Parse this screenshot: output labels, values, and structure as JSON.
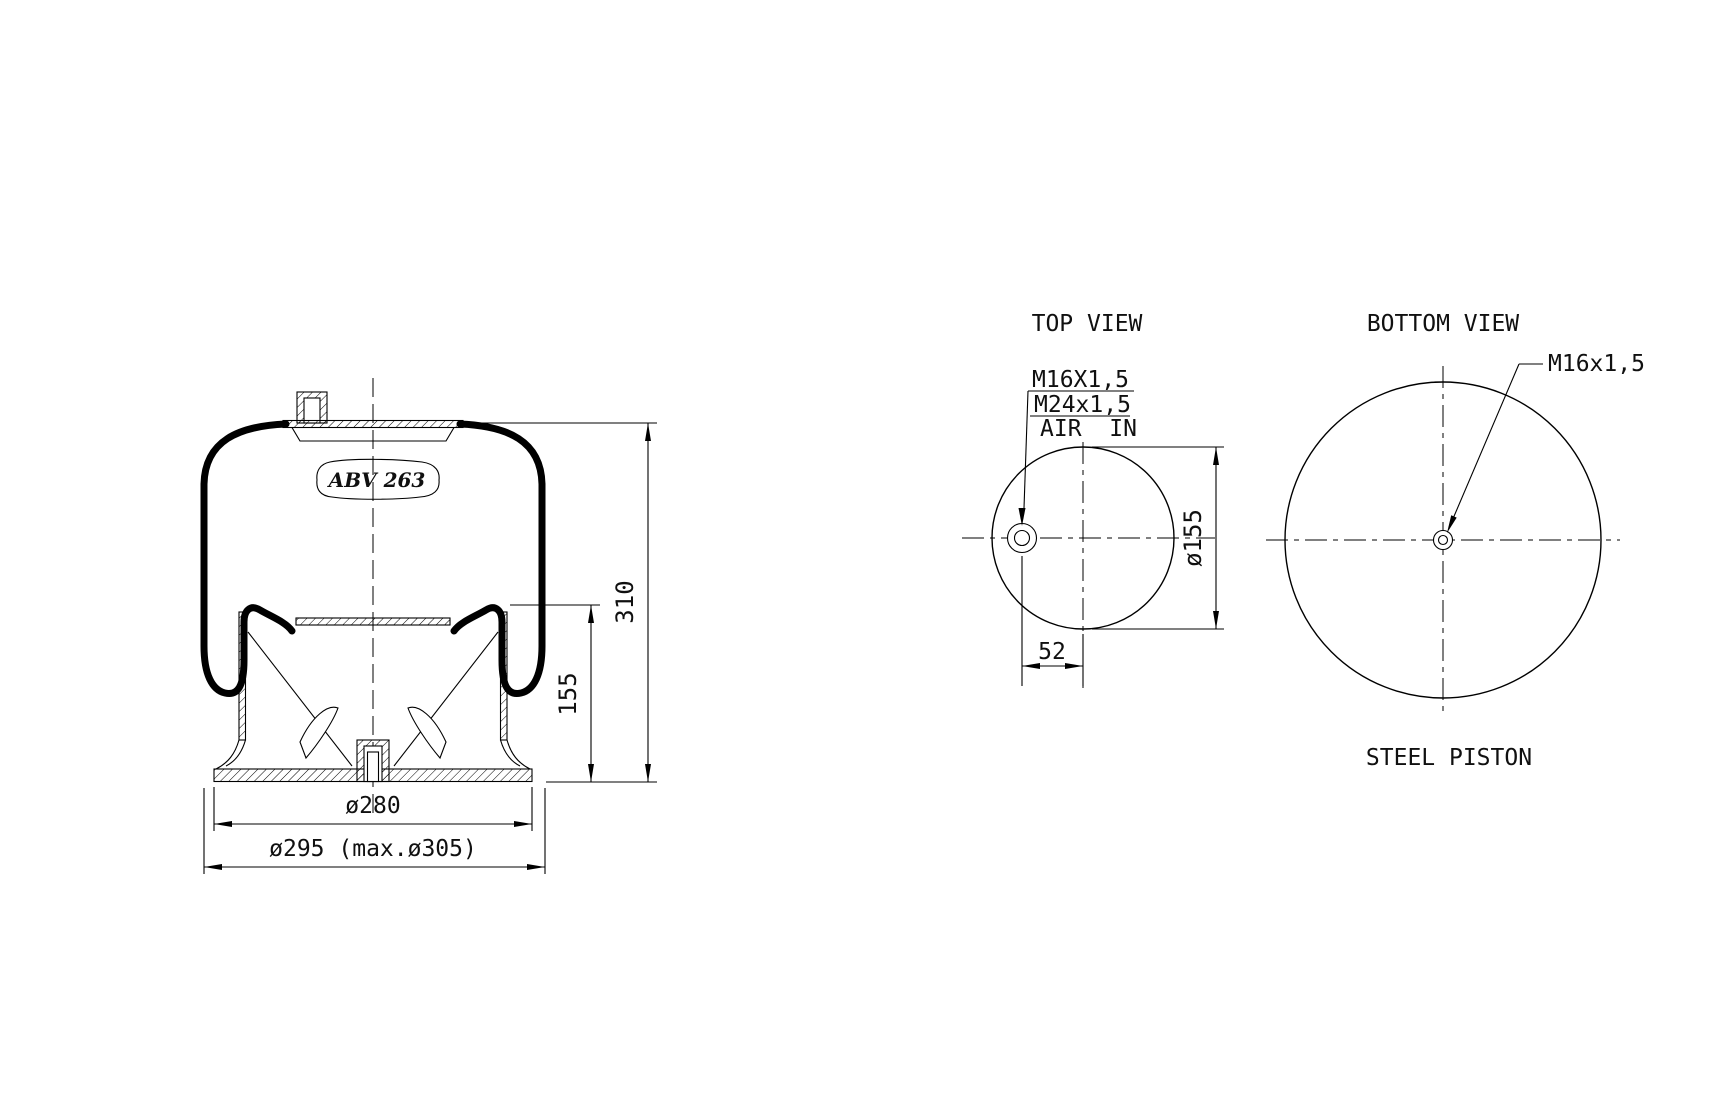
{
  "side_view": {
    "part_label": "ABV 263",
    "dims": {
      "total_height": "310",
      "piston_height": "155",
      "piston_diameter": "ø280",
      "max_diameter": "ø295 (max.ø305)"
    }
  },
  "top_view": {
    "title": "TOP VIEW",
    "thread_top": "M16X1,5",
    "thread_port": "M24x1,5",
    "air_in": "AIR  IN",
    "circle_diameter": "ø155",
    "port_offset": "52"
  },
  "bottom_view": {
    "title": "BOTTOM VIEW",
    "thread": "M16x1,5",
    "caption": "STEEL PISTON"
  }
}
